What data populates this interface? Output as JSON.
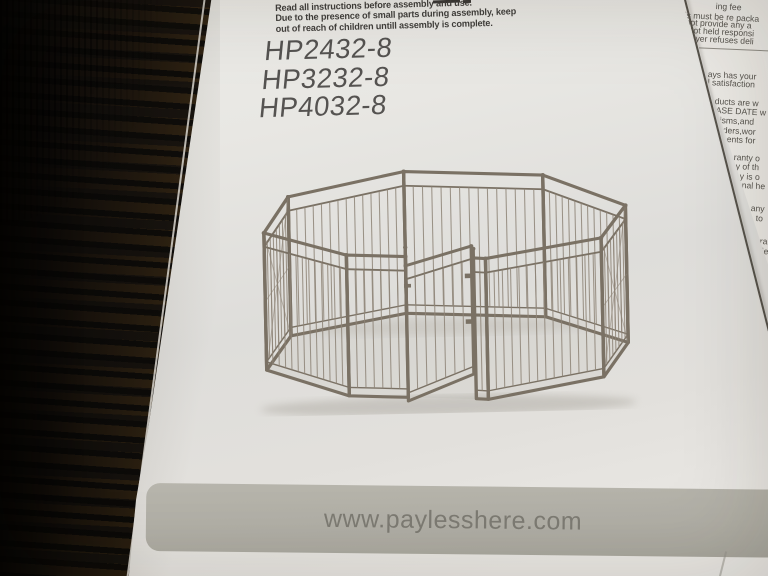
{
  "scene": {
    "description": "photo of a pet playpen instruction sheet lying on stacked dark metal grid panels",
    "background_bar_color": "#17140f",
    "background_wood_color": "#664b29",
    "paper_color": "#e7e5e1"
  },
  "manual": {
    "warning_lines": [
      "Read all instructions before assembly and use.",
      "Due to the presence of small parts during assembly, keep",
      "out of reach of children untill assembly is complete."
    ],
    "model_numbers": [
      "HP2432-8",
      "HP3232-8",
      "HP4032-8"
    ],
    "illustration_name": "8-panel metal dog playpen with swing door",
    "illustration_frame_color": "#7a7164",
    "footer": {
      "website": "www.paylesshere.com",
      "band_color": "#b3b1a8",
      "text_color": "#7d7b73"
    }
  },
  "side_page": {
    "lines": [
      "ing fee",
      "is must be re packa",
      "not provide any a",
      "not held responsi",
      "uyer refuses deli",
      "ays has your",
      "l satisfaction",
      "ducts are w",
      "ASE DATE w",
      "isms,and",
      "ders,wor",
      "ents for",
      "ranty o",
      "y of th",
      "y is o",
      "nal he",
      "any",
      "to",
      "ra",
      "ie"
    ]
  }
}
